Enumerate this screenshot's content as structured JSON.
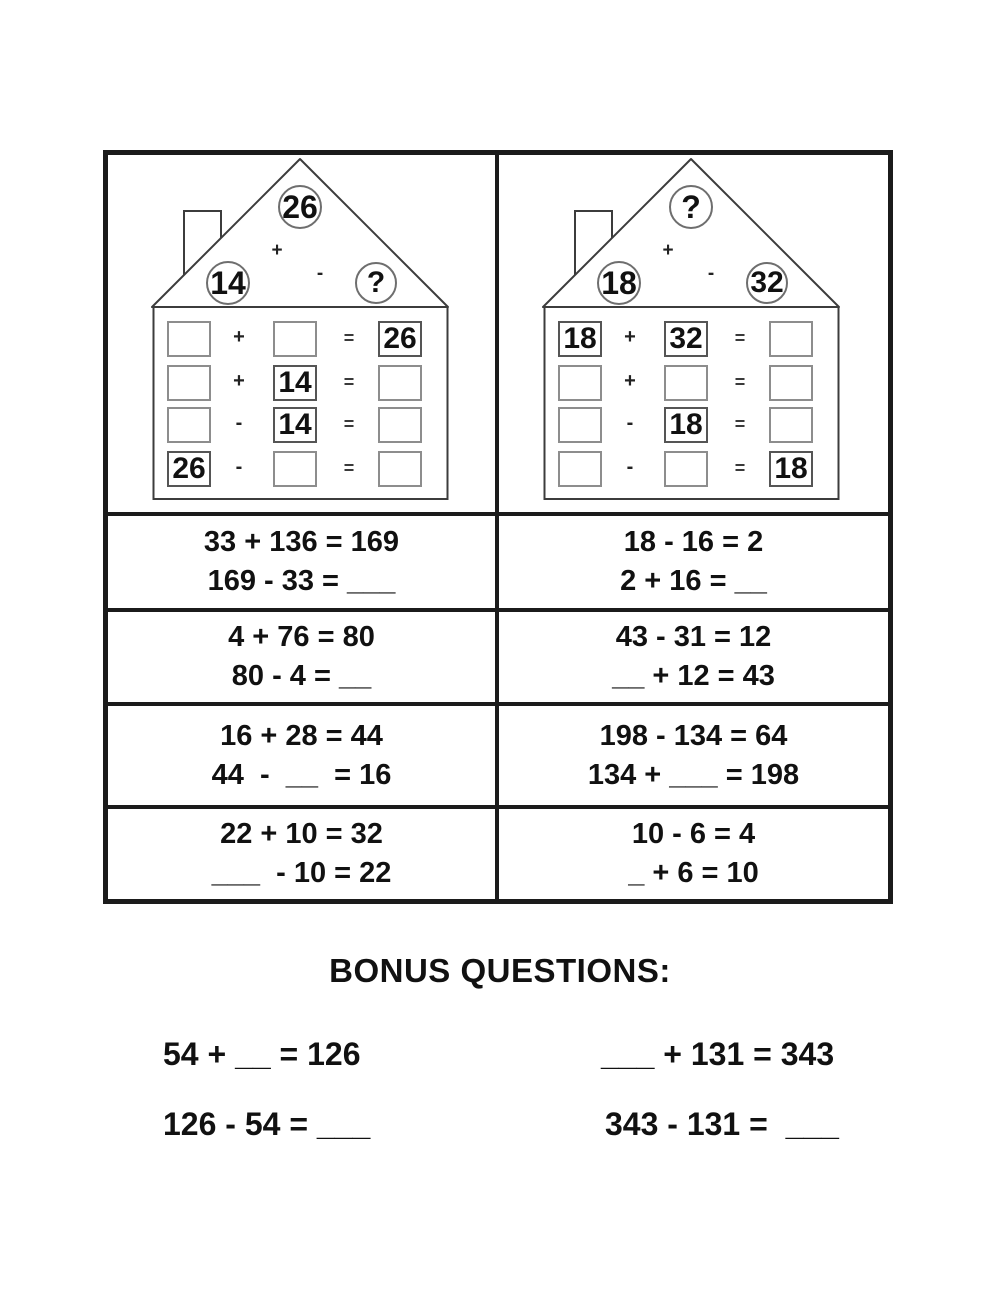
{
  "houses": [
    {
      "side": "left",
      "roof": {
        "top": "26",
        "left": "14",
        "right": "?",
        "plus": "+",
        "minus": "-"
      },
      "rows": [
        {
          "a": "",
          "op": "+",
          "b": "",
          "eq": "=",
          "c": "26"
        },
        {
          "a": "",
          "op": "+",
          "b": "14",
          "eq": "=",
          "c": ""
        },
        {
          "a": "",
          "op": "-",
          "b": "14",
          "eq": "=",
          "c": ""
        },
        {
          "a": "26",
          "op": "-",
          "b": "",
          "eq": "=",
          "c": ""
        }
      ]
    },
    {
      "side": "right",
      "roof": {
        "top": "?",
        "left": "18",
        "right": "32",
        "plus": "+",
        "minus": "-"
      },
      "rows": [
        {
          "a": "18",
          "op": "+",
          "b": "32",
          "eq": "=",
          "c": ""
        },
        {
          "a": "",
          "op": "+",
          "b": "",
          "eq": "=",
          "c": ""
        },
        {
          "a": "",
          "op": "-",
          "b": "18",
          "eq": "=",
          "c": ""
        },
        {
          "a": "",
          "op": "-",
          "b": "",
          "eq": "=",
          "c": "18"
        }
      ]
    }
  ],
  "problems": [
    {
      "left": [
        "33 + 136 = 169",
        "169 - 33 = ___"
      ],
      "right": [
        "18 - 16 = 2",
        "2 + 16 = __"
      ]
    },
    {
      "left": [
        "4 + 76 = 80",
        "80 - 4 = __"
      ],
      "right": [
        "43 - 31 = 12",
        "__ + 12 = 43"
      ]
    },
    {
      "left": [
        "16 + 28 = 44",
        "44  -  __  = 16"
      ],
      "right": [
        "198 - 134 = 64",
        "134 + ___ = 198"
      ]
    },
    {
      "left": [
        "22 + 10 = 32",
        "___  - 10 = 22"
      ],
      "right": [
        "10 - 6 = 4",
        "_ + 6 = 10"
      ]
    }
  ],
  "bonus": {
    "title": "BONUS QUESTIONS:",
    "left": [
      "54 + __ = 126",
      "126 - 54 = ___"
    ],
    "right": [
      "___ + 131 = 343",
      "343 - 131 =  ___"
    ]
  },
  "colors": {
    "grid_line": "#1b1b1b",
    "house_outline": "#3c3c3c",
    "box_border": "#8d8d8d",
    "text": "#111111"
  }
}
